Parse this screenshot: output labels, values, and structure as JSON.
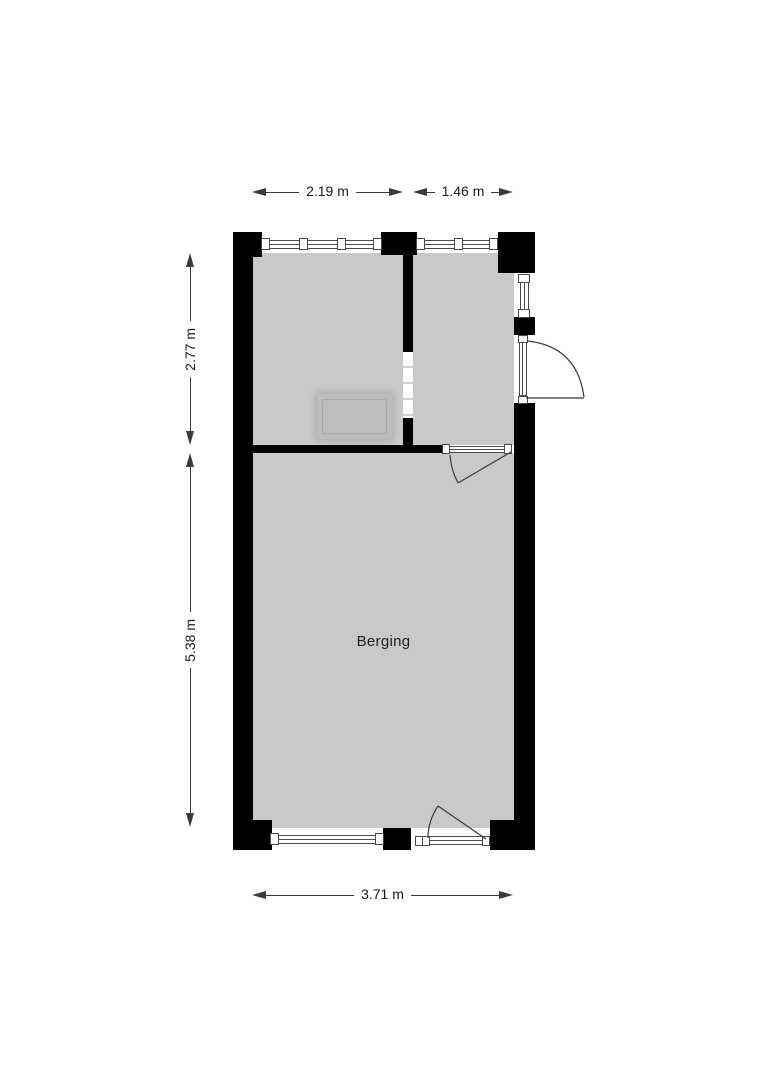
{
  "floorplan": {
    "room_labels": {
      "berging": "Berging"
    },
    "dimensions": {
      "top_left": "2.19 m",
      "top_right": "1.46 m",
      "side_upper": "2.77 m",
      "side_lower": "5.38 m",
      "bottom": "3.71 m"
    },
    "colors": {
      "wall": "#000000",
      "floor": "#c9c9c9",
      "dimension_line": "#3a3a3a",
      "window_frame": "#4a4a4a",
      "furniture_fill": "#bdbdbd",
      "background": "#ffffff"
    }
  }
}
